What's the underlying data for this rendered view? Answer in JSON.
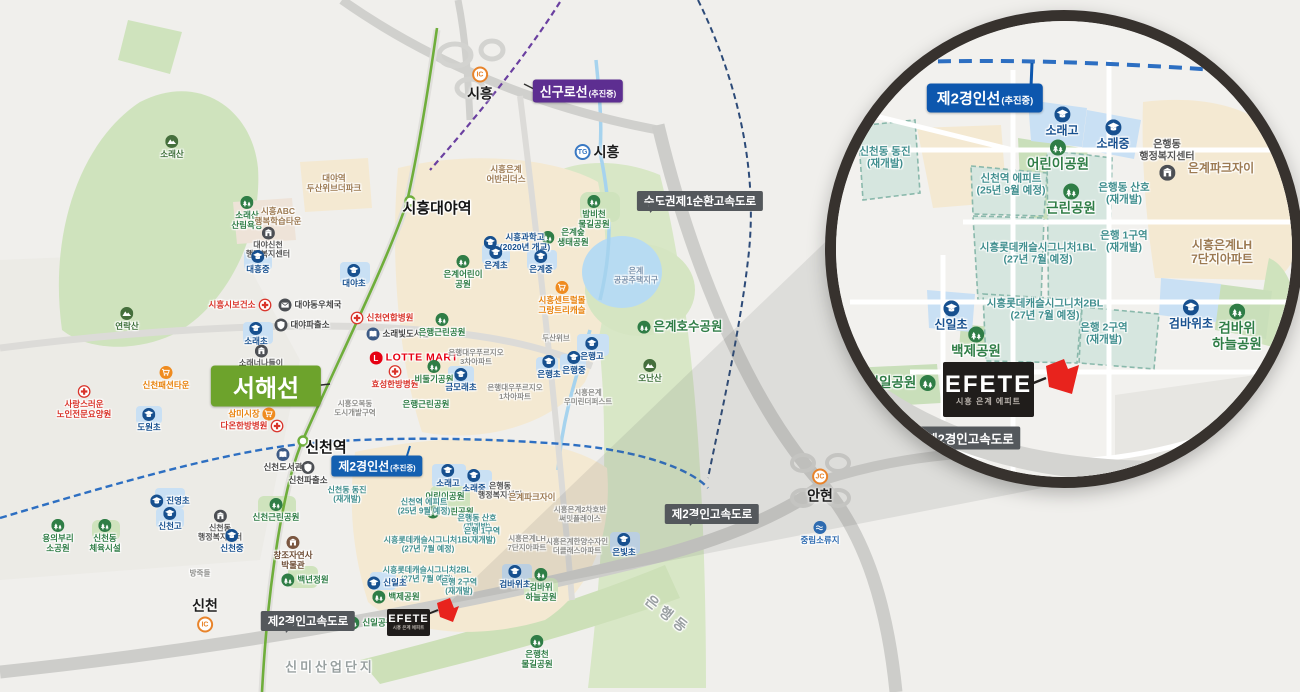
{
  "palette": {
    "accent_red": "#e8231d",
    "rail_green": "#6fae3b",
    "line_blue": "#2d6fc2",
    "line_purple": "#6a3fa0",
    "line_navy": "#2c4a78",
    "badge_dark": "#54585c",
    "badge_green": "#6da32c",
    "badge_blue": "#0d57ae",
    "badge_purple": "#5d2e91",
    "park_green": "#cfe3bd",
    "school_blue": "#c9e0f4",
    "redev_teal": "#d6e6df"
  },
  "main_map": {
    "efete": {
      "logo": "EFETE",
      "subtitle": "시흥 은계 에피트"
    },
    "badges": [
      {
        "style": "purple",
        "x": 578,
        "y": 91,
        "text": "신구로선",
        "sub": "(추진중)"
      },
      {
        "style": "dark",
        "x": 700,
        "y": 201,
        "text": "수도권제1순환고속도로",
        "pt": "bl"
      },
      {
        "style": "green-big",
        "x": 266,
        "y": 386,
        "text": "서해선"
      },
      {
        "style": "blue",
        "x": 377,
        "y": 466,
        "text": "제2경인선",
        "sub": "(추진중)"
      },
      {
        "style": "dark",
        "x": 308,
        "y": 621,
        "text": "제2경인고속도로",
        "pt": "b"
      },
      {
        "style": "dark",
        "x": 712,
        "y": 514,
        "text": "제2경인고속도로",
        "pt": "b"
      }
    ],
    "interchanges": [
      {
        "kind": "IC",
        "label": "시흥",
        "x": 480,
        "y": 85,
        "pos": "bottom",
        "color": "orange"
      },
      {
        "kind": "TG",
        "label": "시흥",
        "x": 597,
        "y": 152,
        "pos": "right",
        "color": "blue"
      },
      {
        "kind": "JC",
        "label": "안현",
        "x": 820,
        "y": 487,
        "pos": "bottom",
        "color": "orange"
      },
      {
        "kind": "IC",
        "label": "신천",
        "x": 205,
        "y": 614,
        "pos": "top",
        "color": "orange"
      }
    ],
    "labels": [
      {
        "t": "소래산",
        "x": 172,
        "y": 147,
        "k": "mtn",
        "ip": "top"
      },
      {
        "t": "소래산\n산림욕장",
        "x": 247,
        "y": 213,
        "k": "park",
        "ip": "top"
      },
      {
        "t": "시흥ABC\n행복학습타운",
        "x": 278,
        "y": 216,
        "k": "brown"
      },
      {
        "t": "대야신천\n행정복지센터",
        "x": 268,
        "y": 243,
        "k": "civic",
        "ip": "top"
      },
      {
        "t": "대야역\n두산위브더파크",
        "x": 334,
        "y": 183,
        "k": "brown"
      },
      {
        "t": "대흥중",
        "x": 258,
        "y": 262,
        "k": "school",
        "ip": "top"
      },
      {
        "t": "대야초",
        "x": 354,
        "y": 276,
        "k": "school",
        "ip": "top"
      },
      {
        "t": "시흥시보건소",
        "x": 240,
        "y": 305,
        "k": "hosp",
        "ip": "right"
      },
      {
        "t": "대야동우체국",
        "x": 310,
        "y": 305,
        "k": "post",
        "ip": "left"
      },
      {
        "t": "대야파출소",
        "x": 302,
        "y": 325,
        "k": "police",
        "ip": "left"
      },
      {
        "t": "소래초",
        "x": 256,
        "y": 334,
        "k": "school",
        "ip": "top"
      },
      {
        "t": "소래너나들이\n센터",
        "x": 261,
        "y": 361,
        "k": "civic",
        "ip": "top"
      },
      {
        "t": "신천연합병원",
        "x": 382,
        "y": 318,
        "k": "hosp",
        "ip": "left"
      },
      {
        "t": "소래빛도서관",
        "x": 398,
        "y": 334,
        "k": "lib",
        "ip": "left"
      },
      {
        "t": "LOTTE MART",
        "x": 414,
        "y": 358,
        "k": "lotte",
        "ip": "left"
      },
      {
        "t": "효성한방병원",
        "x": 395,
        "y": 377,
        "k": "hosp",
        "ip": "top"
      },
      {
        "t": "비둘기공원",
        "x": 434,
        "y": 372,
        "k": "park",
        "ip": "top"
      },
      {
        "t": "은행근린공원",
        "x": 442,
        "y": 325,
        "k": "park",
        "ip": "top"
      },
      {
        "t": "금모래초",
        "x": 461,
        "y": 380,
        "k": "school",
        "ip": "top"
      },
      {
        "t": "은행근린공원",
        "x": 426,
        "y": 404,
        "k": "park"
      },
      {
        "t": "삼미시장",
        "x": 252,
        "y": 414,
        "k": "mkt",
        "ip": "right"
      },
      {
        "t": "다온한방병원",
        "x": 252,
        "y": 426,
        "k": "hosp",
        "ip": "right"
      },
      {
        "t": "신천패션타운",
        "x": 166,
        "y": 378,
        "k": "mkt",
        "ip": "top"
      },
      {
        "t": "사랑스러운\n노인전문요양원",
        "x": 84,
        "y": 402,
        "k": "hosp",
        "ip": "top"
      },
      {
        "t": "연락산",
        "x": 127,
        "y": 319,
        "k": "mtn",
        "ip": "top"
      },
      {
        "t": "도원초",
        "x": 149,
        "y": 420,
        "k": "school",
        "ip": "top"
      },
      {
        "t": "시흥오복동\n도시개발구역",
        "x": 355,
        "y": 409,
        "k": "gray"
      },
      {
        "t": "신천도서관",
        "x": 283,
        "y": 460,
        "k": "lib",
        "ip": "top"
      },
      {
        "t": "신천파출소",
        "x": 308,
        "y": 473,
        "k": "police",
        "ip": "top"
      },
      {
        "t": "신천동 동진\n(재개발)",
        "x": 347,
        "y": 495,
        "k": "redev"
      },
      {
        "t": "신천근린공원",
        "x": 276,
        "y": 510,
        "k": "park",
        "ip": "top"
      },
      {
        "t": "진영초",
        "x": 170,
        "y": 501,
        "k": "school",
        "ip": "left"
      },
      {
        "t": "신천고",
        "x": 170,
        "y": 519,
        "k": "school",
        "ip": "top"
      },
      {
        "t": "신천동\n행정복지센터",
        "x": 220,
        "y": 526,
        "k": "civic",
        "ip": "top"
      },
      {
        "t": "신천중",
        "x": 232,
        "y": 541,
        "k": "school",
        "ip": "top"
      },
      {
        "t": "신천동\n체육시설",
        "x": 105,
        "y": 536,
        "k": "park",
        "ip": "top"
      },
      {
        "t": "용의부리\n소공원",
        "x": 58,
        "y": 536,
        "k": "park",
        "ip": "top"
      },
      {
        "t": "창조자연사\n박물관",
        "x": 293,
        "y": 553,
        "k": "museum",
        "ip": "top"
      },
      {
        "t": "백년정원",
        "x": 305,
        "y": 580,
        "k": "park",
        "ip": "left"
      },
      {
        "t": "방죽들",
        "x": 200,
        "y": 574,
        "k": "gray"
      },
      {
        "t": "소래고",
        "x": 448,
        "y": 476,
        "k": "school",
        "ip": "top"
      },
      {
        "t": "소래중",
        "x": 474,
        "y": 481,
        "k": "school",
        "ip": "top"
      },
      {
        "t": "어린이공원",
        "x": 445,
        "y": 496,
        "k": "park"
      },
      {
        "t": "은행동\n행정복지센터",
        "x": 500,
        "y": 491,
        "k": "civic"
      },
      {
        "t": "은계파크자이",
        "x": 532,
        "y": 497,
        "k": "brown"
      },
      {
        "t": "근린공원",
        "x": 450,
        "y": 512,
        "k": "park",
        "ip": "left"
      },
      {
        "t": "신천역 에피트\n(25년 9월 예정)",
        "x": 424,
        "y": 507,
        "k": "redev"
      },
      {
        "t": "은행동 산호\n(재개발)",
        "x": 477,
        "y": 523,
        "k": "redev"
      },
      {
        "t": "은행 1구역\n(재개발)",
        "x": 482,
        "y": 536,
        "k": "redev"
      },
      {
        "t": "시흥롯데캐슬시그니처1BL\n(27년 7월 예정)",
        "x": 428,
        "y": 545,
        "k": "redev"
      },
      {
        "t": "시흥롯데캐슬시그니처2BL\n(27년 7월 예정)",
        "x": 427,
        "y": 575,
        "k": "redev"
      },
      {
        "t": "은행 2구역\n(재개발)",
        "x": 459,
        "y": 587,
        "k": "redev"
      },
      {
        "t": "검바위초",
        "x": 515,
        "y": 577,
        "k": "school",
        "ip": "top"
      },
      {
        "t": "검바위\n하늘공원",
        "x": 541,
        "y": 585,
        "k": "park",
        "ip": "top"
      },
      {
        "t": "시흥은계LH\n7단지아파트",
        "x": 527,
        "y": 544,
        "k": "gray"
      },
      {
        "t": "시흥은계2차호반\n써밋플레이스",
        "x": 580,
        "y": 515,
        "k": "gray"
      },
      {
        "t": "시흥은계한양수자인\n더클래스아파트",
        "x": 577,
        "y": 547,
        "k": "gray"
      },
      {
        "t": "시흥은계\n우미린더퍼스트",
        "x": 588,
        "y": 398,
        "k": "gray"
      },
      {
        "t": "은행대우푸르지오\n3차아파트",
        "x": 476,
        "y": 358,
        "k": "gray"
      },
      {
        "t": "은행대우푸르지오\n1차아파트",
        "x": 515,
        "y": 393,
        "k": "gray"
      },
      {
        "t": "두산위브",
        "x": 556,
        "y": 339,
        "k": "gray"
      },
      {
        "t": "은빛초",
        "x": 624,
        "y": 545,
        "k": "school",
        "ip": "top"
      },
      {
        "t": "은계호수공원",
        "x": 680,
        "y": 327,
        "k": "parkbig",
        "ip": "left"
      },
      {
        "t": "오난산",
        "x": 650,
        "y": 371,
        "k": "mtn",
        "ip": "top"
      },
      {
        "t": "은계\n공공주택지구",
        "x": 636,
        "y": 276,
        "k": "bluegray"
      },
      {
        "t": "밤비천\n물길공원",
        "x": 594,
        "y": 212,
        "k": "park",
        "ip": "top"
      },
      {
        "t": "은계숲\n생태공원",
        "x": 565,
        "y": 237,
        "k": "park",
        "ip": "left"
      },
      {
        "t": "시흥과학고\n(2020년 개교)",
        "x": 517,
        "y": 242,
        "k": "school",
        "ip": "left"
      },
      {
        "t": "은계초",
        "x": 496,
        "y": 258,
        "k": "school",
        "ip": "top"
      },
      {
        "t": "은계중",
        "x": 541,
        "y": 262,
        "k": "school",
        "ip": "top"
      },
      {
        "t": "은계어린이\n공원",
        "x": 463,
        "y": 272,
        "k": "park",
        "ip": "top"
      },
      {
        "t": "시흥은계\n어반리더스",
        "x": 506,
        "y": 174,
        "k": "brown"
      },
      {
        "t": "시흥센트럴몰\n그랑트리캐슬",
        "x": 562,
        "y": 298,
        "k": "mkt",
        "ip": "top"
      },
      {
        "t": "은행고",
        "x": 592,
        "y": 349,
        "k": "school",
        "ip": "top"
      },
      {
        "t": "은행중",
        "x": 574,
        "y": 363,
        "k": "school",
        "ip": "top"
      },
      {
        "t": "은행초",
        "x": 549,
        "y": 367,
        "k": "school",
        "ip": "top"
      },
      {
        "t": "중림소류지",
        "x": 820,
        "y": 533,
        "k": "water",
        "ip": "top"
      },
      {
        "t": "은행천\n물길공원",
        "x": 537,
        "y": 652,
        "k": "park",
        "ip": "top"
      },
      {
        "t": "신미산업단지",
        "x": 330,
        "y": 667,
        "k": "area"
      },
      {
        "t": "은행동",
        "x": 668,
        "y": 615,
        "k": "arearot"
      },
      {
        "t": "신일초",
        "x": 387,
        "y": 583,
        "k": "school",
        "ip": "left"
      },
      {
        "t": "백제공원",
        "x": 396,
        "y": 597,
        "k": "park",
        "ip": "left"
      },
      {
        "t": "신일공원",
        "x": 370,
        "y": 623,
        "k": "park",
        "ip": "left"
      },
      {
        "t": "시흥대야역",
        "x": 437,
        "y": 209,
        "k": "stationbig"
      },
      {
        "t": "신천역",
        "x": 326,
        "y": 448,
        "k": "stationbig"
      }
    ]
  },
  "inset": {
    "efete": {
      "logo": "EFETE",
      "subtitle": "시흥 은계 에피트"
    },
    "badges": [
      {
        "style": "blue-big",
        "x": 160,
        "y": 88,
        "text": "제2경인선",
        "sub": "(추진중)"
      },
      {
        "style": "dark-big",
        "x": 145,
        "y": 428,
        "text": "제2경인고속도로"
      }
    ],
    "labels": [
      {
        "t": "소래고",
        "x": 237,
        "y": 112,
        "k": "school",
        "ip": "top"
      },
      {
        "t": "소래중",
        "x": 288,
        "y": 125,
        "k": "school",
        "ip": "top"
      },
      {
        "t": "어린이공원",
        "x": 233,
        "y": 146,
        "k": "parkbig",
        "ip": "top"
      },
      {
        "t": "은행동\n행정복지센터",
        "x": 342,
        "y": 150,
        "k": "civic",
        "ip": "bottom"
      },
      {
        "t": "은계파크자이",
        "x": 396,
        "y": 158,
        "k": "brown"
      },
      {
        "t": "신천동 동진\n(재개발)",
        "x": 60,
        "y": 148,
        "k": "redev"
      },
      {
        "t": "신천역 에피트\n(25년 9월 예정)",
        "x": 186,
        "y": 175,
        "k": "redev"
      },
      {
        "t": "근린공원",
        "x": 246,
        "y": 190,
        "k": "parkbig",
        "ip": "top"
      },
      {
        "t": "은행동 산호\n(재개발)",
        "x": 299,
        "y": 184,
        "k": "redev"
      },
      {
        "t": "은행 1구역\n(재개발)",
        "x": 299,
        "y": 232,
        "k": "redev"
      },
      {
        "t": "시흥롯데캐슬시그니처1BL\n(27년 7월 예정)",
        "x": 213,
        "y": 244,
        "k": "redev"
      },
      {
        "t": "시흥은계LH\n7단지아파트",
        "x": 397,
        "y": 242,
        "k": "brown"
      },
      {
        "t": "신일초",
        "x": 126,
        "y": 306,
        "k": "school",
        "ip": "top"
      },
      {
        "t": "백제공원",
        "x": 151,
        "y": 333,
        "k": "parkbig",
        "ip": "top"
      },
      {
        "t": "시흥롯데캐슬시그니처2BL\n(27년 7월 예정)",
        "x": 220,
        "y": 300,
        "k": "redev"
      },
      {
        "t": "은행 2구역\n(재개발)",
        "x": 279,
        "y": 324,
        "k": "redev"
      },
      {
        "t": "검바위초",
        "x": 366,
        "y": 305,
        "k": "school",
        "ip": "top"
      },
      {
        "t": "검바위\n하늘공원",
        "x": 412,
        "y": 318,
        "k": "parkbig",
        "ip": "top"
      },
      {
        "t": "신일공원",
        "x": 76,
        "y": 373,
        "k": "parkbig",
        "ip": "right"
      }
    ]
  }
}
